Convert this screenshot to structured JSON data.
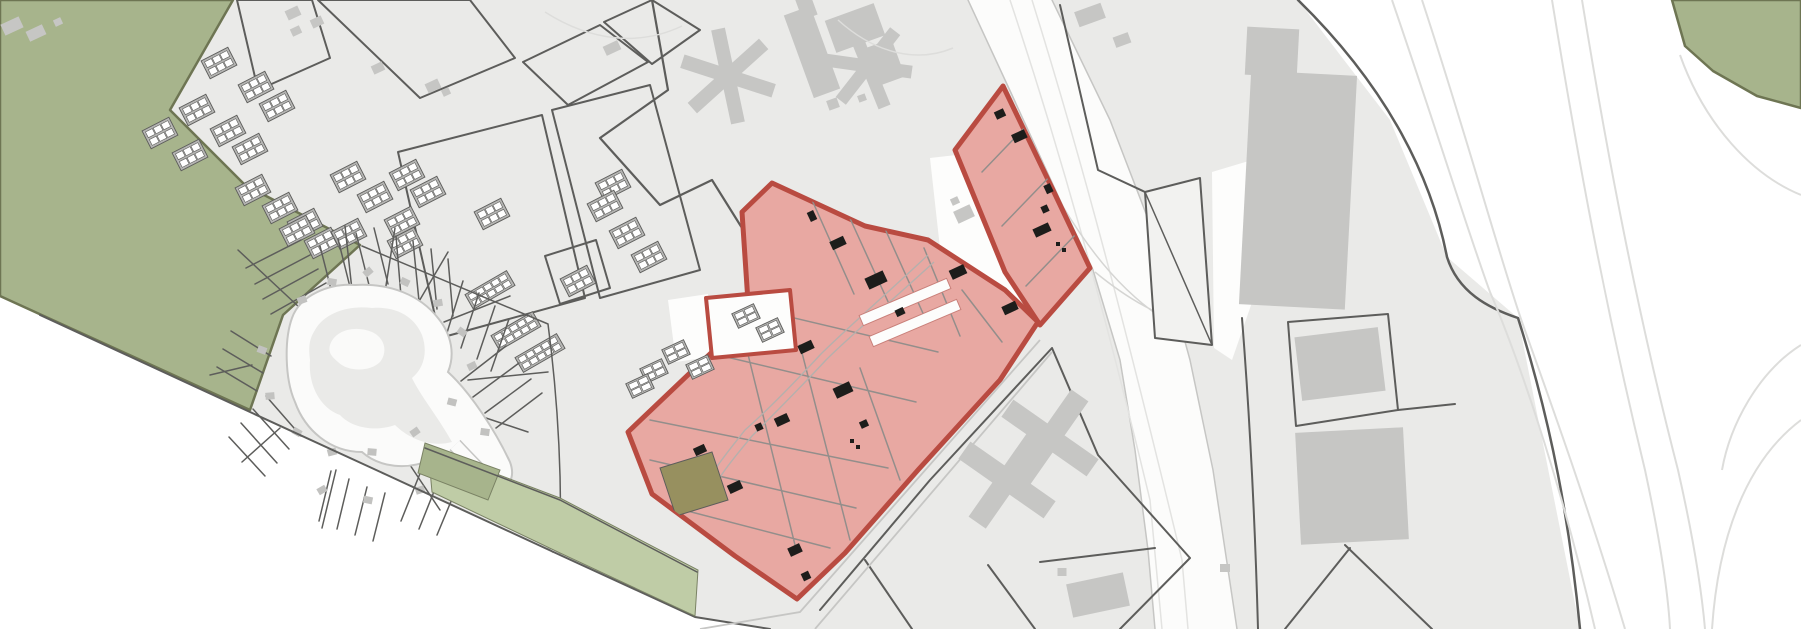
{
  "meta": {
    "kind": "architectural-site-plan-map",
    "visible_text": "none",
    "orientation": "plan rotated roughly 25 degrees, no labels or legend rendered in pixels"
  },
  "palette": {
    "page": "#ffffff",
    "urban": "#eaeae8",
    "outline": "#5d5d5b",
    "parcel": "#9b9794",
    "bldg": "#c6c6c4",
    "dark": "#1d1d1b",
    "gh": "#b5b5b3",
    "field_green": "#a7b48c",
    "sageborder": "#6e7553",
    "verge_green": "#bfcca6",
    "stripedge": "#7a8264",
    "zone_fill": "#e8a8a2",
    "zoneborder": "#b94b41",
    "zoneline": "#938e8b",
    "olive_parcel": "#97905f",
    "road_fill": "#fcfcfb",
    "roadedge": "#c6c6c4",
    "faint": "#dddddb",
    "white": "#fdfdfc",
    "triangle": "#f2f2f0",
    "court_edge": "#c9807a"
  },
  "features": [
    {
      "name": "field-green-west",
      "kind": "green-area",
      "color_key": "field_green"
    },
    {
      "name": "green-area-northeast",
      "kind": "green-area",
      "color_key": "field_green"
    },
    {
      "name": "roadside-verge",
      "kind": "green-strip",
      "color_key": "verge_green"
    },
    {
      "name": "highlighted-zone",
      "kind": "selected-planning-area",
      "color_key": "zone_fill",
      "border_key": "zoneborder",
      "black_building_count": 20
    },
    {
      "name": "olive-parcel",
      "kind": "parcel",
      "color_key": "olive_parcel"
    },
    {
      "name": "main-road",
      "kind": "road",
      "color_key": "road_fill"
    },
    {
      "name": "allotment-gardens",
      "kind": "radial-parcel-area"
    },
    {
      "name": "greenhouse-blocks",
      "kind": "gridded-buildings",
      "count": 26
    },
    {
      "name": "long-greenhouse-rows",
      "kind": "gridded-buildings",
      "count": 3
    },
    {
      "name": "garage-courts",
      "kind": "gridded-buildings",
      "count": 6
    },
    {
      "name": "star-buildings",
      "kind": "buildings",
      "count": 2
    },
    {
      "name": "cross-buildings",
      "kind": "buildings",
      "count": 2
    },
    {
      "name": "tower-building",
      "kind": "building"
    },
    {
      "name": "highway-ramps",
      "kind": "faint-road-lines"
    }
  ]
}
